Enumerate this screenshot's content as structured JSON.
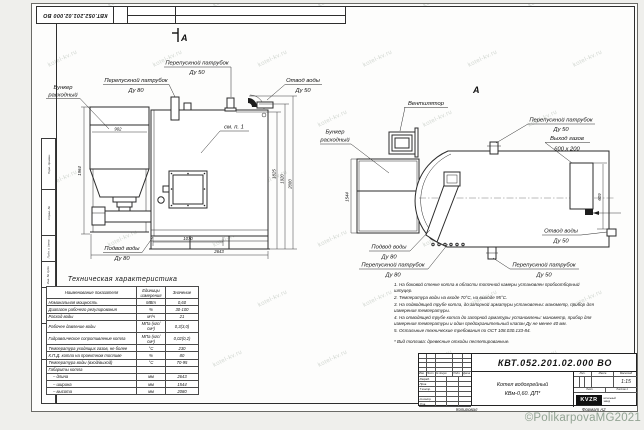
{
  "watermark": {
    "text": "kotel-kv.ru"
  },
  "stamp": {
    "doc_number": "КВТ.052.201.02.000  ВО"
  },
  "margin": {
    "cells": [
      {
        "label": "Перв. примен.",
        "h": 50
      },
      {
        "label": "Справ. №",
        "h": 45
      },
      {
        "label": "Подп. и дата",
        "h": 25
      },
      {
        "label": "Инв. № дубл.",
        "h": 25
      },
      {
        "label": "Взам. инв. №",
        "h": 35
      },
      {
        "label": "Подп. и дата",
        "h": 35
      },
      {
        "label": "Инв. № подл.",
        "h": 43
      }
    ]
  },
  "fv": {
    "mark": "А",
    "bunker1": "Бункер",
    "bunker2": "расходный",
    "pp80_1": "Перепускной патрубок",
    "pp80_2": "Ду 80",
    "pp50_1": "Перепускной патрубок",
    "pp50_2": "Ду 50",
    "otvod1": "Отвод воды",
    "otvod2": "Ду 50",
    "see": "см. п. 1",
    "podvod1": "Подвод воды",
    "podvod2": "Ду 80",
    "d902": "902",
    "d1964": "1964",
    "d1825": "1825",
    "d1920": "1920",
    "d2080": "2080",
    "d1070": "1070",
    "d2643": "2643"
  },
  "sv": {
    "mark": "А",
    "fan": "Вентилятор",
    "bunker1": "Бункер",
    "bunker2": "расходный",
    "pp50t_1": "Перепускной патрубок",
    "pp50t_2": "Ду 50",
    "gas1": "Выход газов",
    "gas2": "600 х 200",
    "otvod1": "Отвод воды",
    "otvod2": "Ду 50",
    "podvod1": "Подвод воды",
    "podvod2": "Ду 80",
    "pp80_1": "Перепускной патрубок",
    "pp80_2": "Ду 80",
    "pp50b_1": "Перепускной патрубок",
    "pp50b_2": "Ду 50",
    "d1544": "1544",
    "d609": "609"
  },
  "table": {
    "title": "Техническая характеристика",
    "headers": [
      "Наименование показателя",
      "Единицы измерения",
      "Значение"
    ],
    "rows": [
      [
        "Номинальная мощность",
        "МВт",
        "0,60"
      ],
      [
        "Диапазон рабочего регулирования",
        "%",
        "30-100"
      ],
      [
        "Расход воды",
        "м³/ч",
        "21"
      ],
      [
        "Рабочее давление воды",
        "МПа (кгс/см²)",
        "0,3(3,0)"
      ],
      [
        "Гидравлическое сопротивление котла",
        "МПа (кгс/см²)",
        "0,02(0,2)"
      ],
      [
        "Температура уходящих газов, не более",
        "°С",
        "230"
      ],
      [
        "К.П.Д. котла на проектном топливе",
        "%",
        "80"
      ],
      [
        "Температура воды (вход/выход)",
        "°С",
        "70-95"
      ],
      [
        "Габариты котла",
        "",
        ""
      ],
      [
        "– длина",
        "мм",
        "2643"
      ],
      [
        "– ширина",
        "мм",
        "1544"
      ],
      [
        "– высота",
        "мм",
        "2080"
      ]
    ]
  },
  "notes": {
    "items": [
      "1. На боковой стенке котла в области топочной камеры установлен пробоотборный штуцер.",
      "2. Температура воды на входе 70°С, на выходе 95°С.",
      "3. На подводящей трубе котла, до запорной арматуры установлены: манометр, прибор для измерения температуры.",
      "4. На отводящей трубе котла до запорной арматуры установлены: манометр, прибор для измерения температуры и один предохранительный клапан Ду не менее 40 мм.",
      "5. Остальные технические требования по ОСТ 108.030.133-84."
    ],
    "fuel": "* Вид топлива: древесные отходы пеллетированные."
  },
  "tb": {
    "doc_number": "КВТ.052.201.02.000  ВО",
    "name1": "Котел водогрейный",
    "name2": "КВм-0,60.  ДП*",
    "cols": [
      "Изм.",
      "Лист",
      "№ докум.",
      "Подп.",
      "Дата"
    ],
    "roles": [
      "Разраб.",
      "Пров.",
      "Т.контр.",
      "",
      "Н.контр.",
      "Утв."
    ],
    "lit": "Лит.",
    "mass": "Масса",
    "scale_lbl": "Масштаб",
    "scale": "1:15",
    "sheet": "Лист",
    "sheets": "Листов 1",
    "logo": "KVZR",
    "logo_cap1": "котельный",
    "logo_cap2": "завод"
  },
  "footer": {
    "copied": "Копировал",
    "format": "Формат А2",
    "copyright": "©PolikarpovaMG2021"
  }
}
